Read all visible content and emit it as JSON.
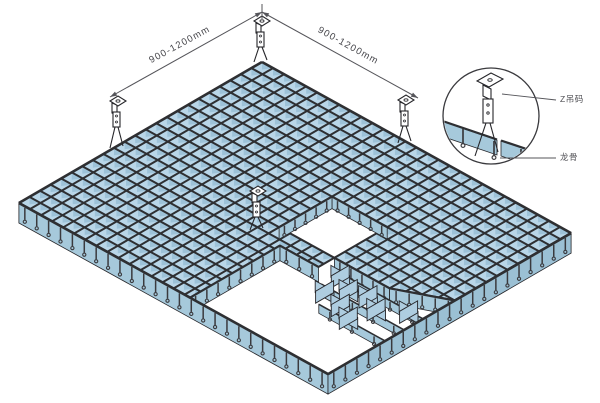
{
  "dimensions": {
    "left_label": "900-1200mm",
    "right_label": "900-1200mm"
  },
  "detail": {
    "labels": [
      {
        "text": "Z吊码",
        "x": 560,
        "y": 102
      },
      {
        "text": "龙骨",
        "x": 560,
        "y": 160
      }
    ]
  },
  "colors": {
    "background": "#ffffff",
    "cell_fill": "#b9d6e8",
    "fin_fill": "#9dc2d8",
    "grid_line": "#2e2f32",
    "outline": "#26262a",
    "fascia_left": "#a6c9db",
    "fascia_right": "#9bc0d4",
    "wall_fill": "#a6c9db",
    "blade_fill": "#aecde0",
    "hook": "#3a3a3e",
    "dim_line": "#55555a",
    "text": "#46464b",
    "label_text": "#515156"
  },
  "diagram": {
    "grid": {
      "origin": [
        262,
        62
      ],
      "u": [
        11.04,
        6.11
      ],
      "v": [
        -10.57,
        6.13
      ],
      "cols": 28,
      "rows": 23,
      "fin_height": 7.5,
      "fascia_height": 20
    },
    "holes": [
      {
        "poly": [
          [
            14,
            8
          ],
          [
            19,
            8
          ],
          [
            19,
            13
          ],
          [
            14,
            13
          ]
        ],
        "walls": [
          {
            "from": [
              14,
              8
            ],
            "to": [
              19,
              8
            ],
            "h": 12
          },
          {
            "from": [
              14,
              8
            ],
            "to": [
              14,
              13
            ],
            "h": 12
          }
        ]
      },
      {
        "poly": [
          [
            19,
            13
          ],
          [
            24,
            13
          ],
          [
            28,
            11
          ],
          [
            28,
            23
          ],
          [
            15.5,
            23
          ],
          [
            15.5,
            14.5
          ],
          [
            19,
            14.5
          ]
        ],
        "walls": [
          {
            "from": [
              19,
              13
            ],
            "to": [
              24,
              13
            ],
            "h": 15
          },
          {
            "from": [
              24,
              13
            ],
            "to": [
              28,
              11
            ],
            "h": 15
          },
          {
            "from": [
              15.5,
              14.5
            ],
            "to": [
              19,
              14.5
            ],
            "h": 15
          },
          {
            "from": [
              15.5,
              14.5
            ],
            "to": [
              15.5,
              23
            ],
            "h": 15
          }
        ]
      }
    ],
    "runners": [
      {
        "from": [
          20,
          14
        ],
        "to": [
          28,
          14
        ]
      },
      {
        "from": [
          20.5,
          15.8
        ],
        "to": [
          28,
          15.8
        ]
      },
      {
        "from": [
          22,
          17.6
        ],
        "to": [
          28,
          17.6
        ]
      }
    ],
    "blades": [
      [
        20.3,
        13.8
      ],
      [
        21.8,
        14.6
      ],
      [
        20.8,
        15.8
      ],
      [
        23.2,
        14.2
      ],
      [
        22.6,
        16.2
      ],
      [
        24.6,
        14.9
      ],
      [
        24,
        16.9
      ],
      [
        26.3,
        13.6
      ]
    ],
    "hangers": [
      {
        "x": 118,
        "top": 96,
        "base": 148
      },
      {
        "x": 262,
        "top": 16,
        "base": 62
      },
      {
        "x": 406,
        "top": 95,
        "base": 143
      },
      {
        "x": 258,
        "top": 186,
        "base": 230
      }
    ],
    "dims": {
      "peak": [
        262,
        12
      ],
      "left_end": [
        110,
        97
      ],
      "right_end": [
        418,
        98
      ],
      "left_label_pos": [
        181,
        47,
        -28.6
      ],
      "right_label_pos": [
        347,
        48,
        28.8
      ]
    },
    "detail": {
      "center": [
        491,
        116
      ],
      "r": 48,
      "band1": [
        [
          444,
          122
        ],
        [
          497,
          140
        ],
        [
          497,
          155
        ],
        [
          444,
          137
        ]
      ],
      "band2": [
        [
          501,
          141
        ],
        [
          540,
          154
        ],
        [
          540,
          169
        ],
        [
          501,
          156
        ]
      ],
      "hooks": [
        [
          463,
          127
        ],
        [
          494,
          139
        ],
        [
          521,
          147
        ]
      ],
      "leaders": [
        [
          [
            502,
            94
          ],
          [
            556,
            100
          ]
        ],
        [
          [
            500,
            158
          ],
          [
            556,
            158
          ]
        ]
      ]
    }
  }
}
